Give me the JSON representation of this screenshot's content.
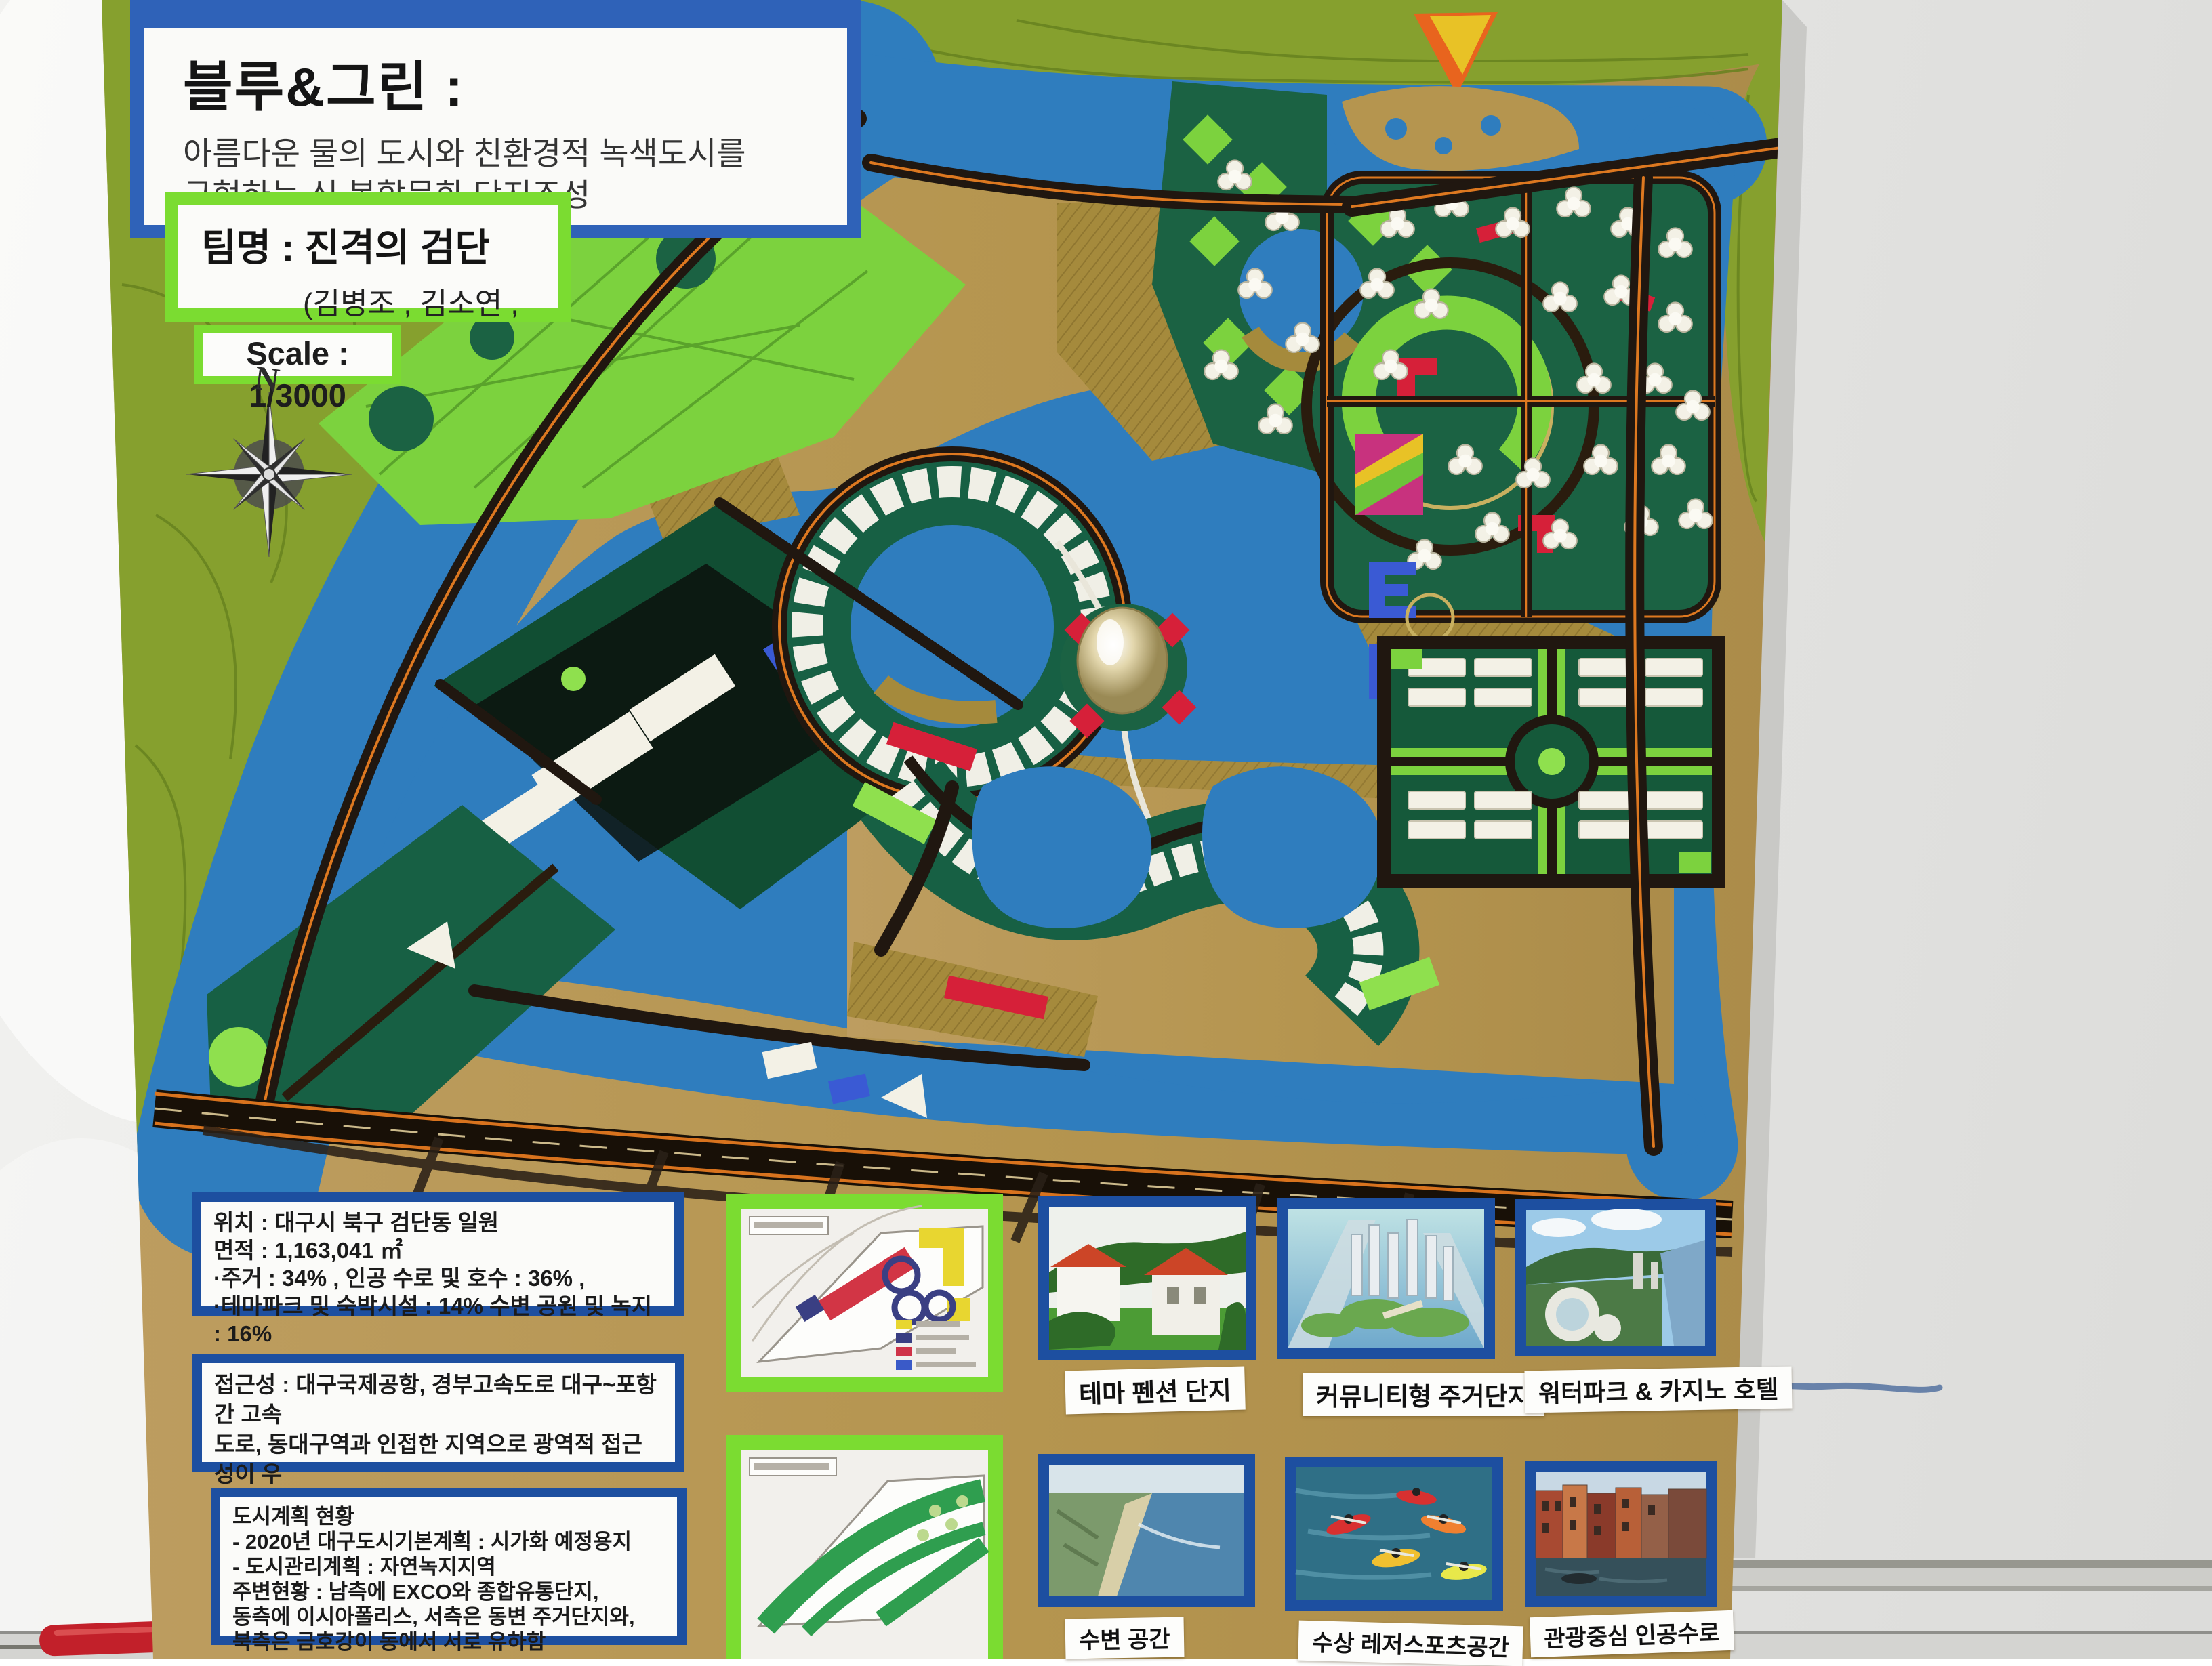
{
  "board": {
    "title_box": {
      "title": "블루&그린 :",
      "line1": "아름다운 물의 도시와 친환경적 녹색도시를",
      "line2": "구현하는 신 복합문화 단지조성"
    },
    "team_box": {
      "line1": "팀명 : 진격의 검단",
      "line2": "(김병조 , 김소연 , 윤종민)"
    },
    "scale_label": "Scale : 1/3000",
    "compass_n": "N"
  },
  "info_boxes": [
    {
      "lines": [
        "위치 : 대구시 북구 검단동 일원",
        "면적 : 1,163,041 ㎡",
        "·주거 : 34% , 인공 수로 및 호수 : 36% ,",
        "·테마파크 및 숙박시설 : 14% 수변 공원 및 녹지 : 16%"
      ]
    },
    {
      "lines": [
        "접근성 : 대구국제공항, 경부고속도로 대구~포항간 고속",
        "도로, 동대구역과 인접한 지역으로 광역적 접근성이 우",
        "수한 지역"
      ]
    },
    {
      "lines": [
        "도시계획 현황",
        "- 2020년 대구도시기본계획 : 시가화 예정용지",
        "- 도시관리계획 : 자연녹지지역",
        "주변현황 : 남측에 EXCO와 종합유통단지,",
        "동측에 이시아폴리스, 서측은 동변 주거단지와,",
        "북측은 금호강이 동에서 서로 유하함"
      ]
    }
  ],
  "photos": [
    {
      "caption": "테마 펜션 단지"
    },
    {
      "caption": "커뮤니티형 주거단지"
    },
    {
      "caption": "워터파크 & 카지노 호텔"
    },
    {
      "caption": "수변 공간"
    },
    {
      "caption": "수상 레저스포츠공간"
    },
    {
      "caption": "관광중심 인공수로"
    }
  ],
  "colors": {
    "board_tan": "#b5954f",
    "hill_olive": "#86a02e",
    "water_blue": "#2f7dbe",
    "parcel_dark_green": "#1b6243",
    "parcel_bright_green": "#7cd23e",
    "road_dark": "#201710",
    "road_orange": "#dd7820",
    "accent_red": "#d62039",
    "frame_blue": "#1d4fa0",
    "frame_green": "#7bdc31",
    "whiteboard": "#e7e7e5"
  }
}
